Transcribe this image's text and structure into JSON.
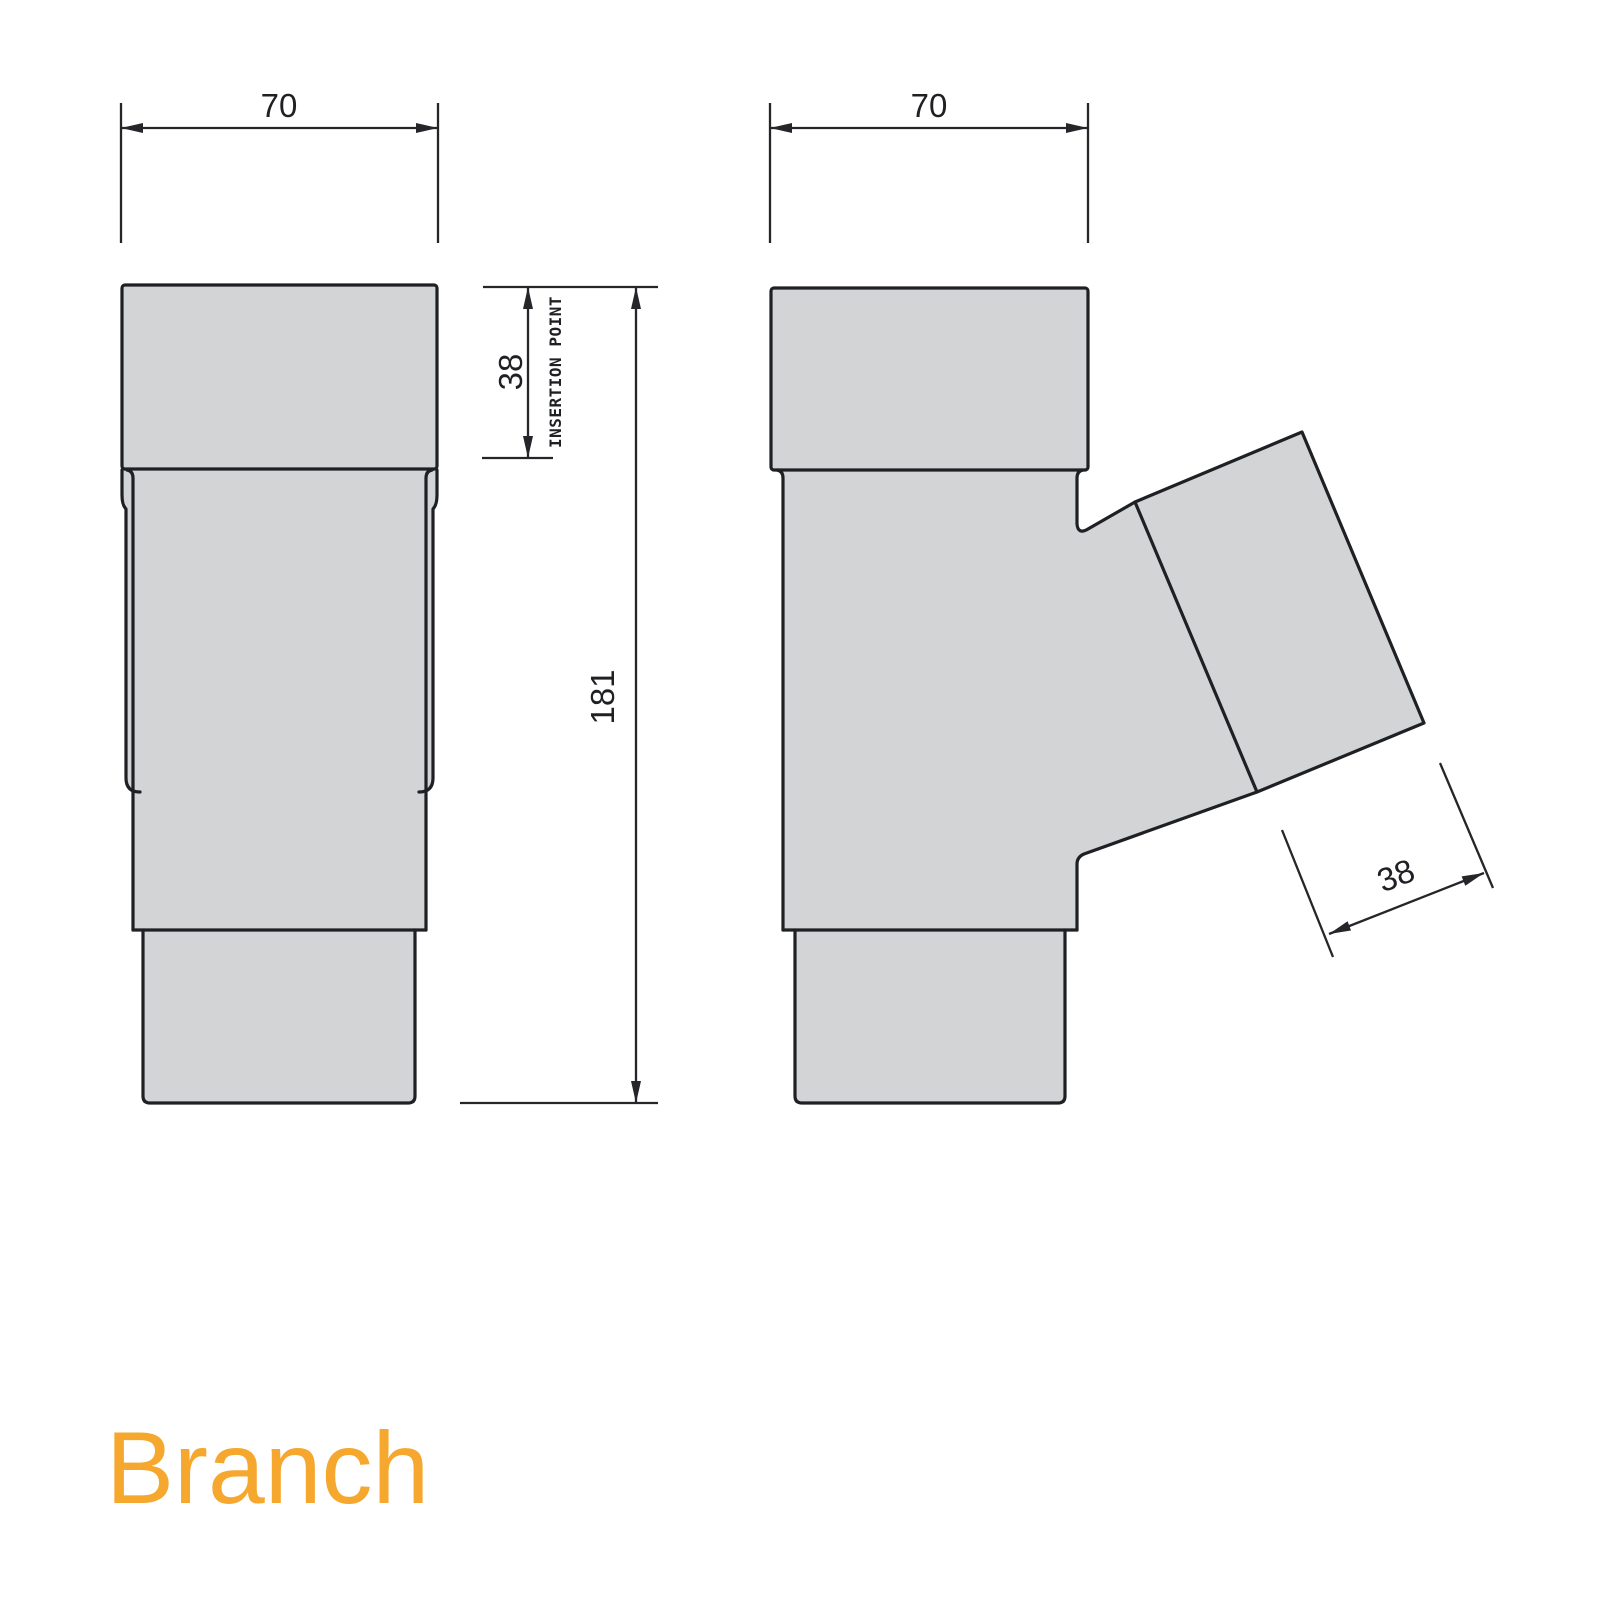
{
  "drawing": {
    "title": "Branch",
    "views": {
      "front": {
        "name": "front-elevation"
      },
      "side": {
        "name": "side-elevation-with-branch"
      }
    },
    "dimensions": {
      "front_width": "70",
      "side_width": "70",
      "insertion_depth": "38",
      "insertion_label": "INSERTION POINT",
      "overall_height": "181",
      "branch_insertion_depth": "38"
    },
    "colors": {
      "background": "#ffffff",
      "part_fill": "#d3d4d6",
      "outline": "#1f2024",
      "dimension": "#26262a",
      "accent": "#f5a72e"
    }
  }
}
